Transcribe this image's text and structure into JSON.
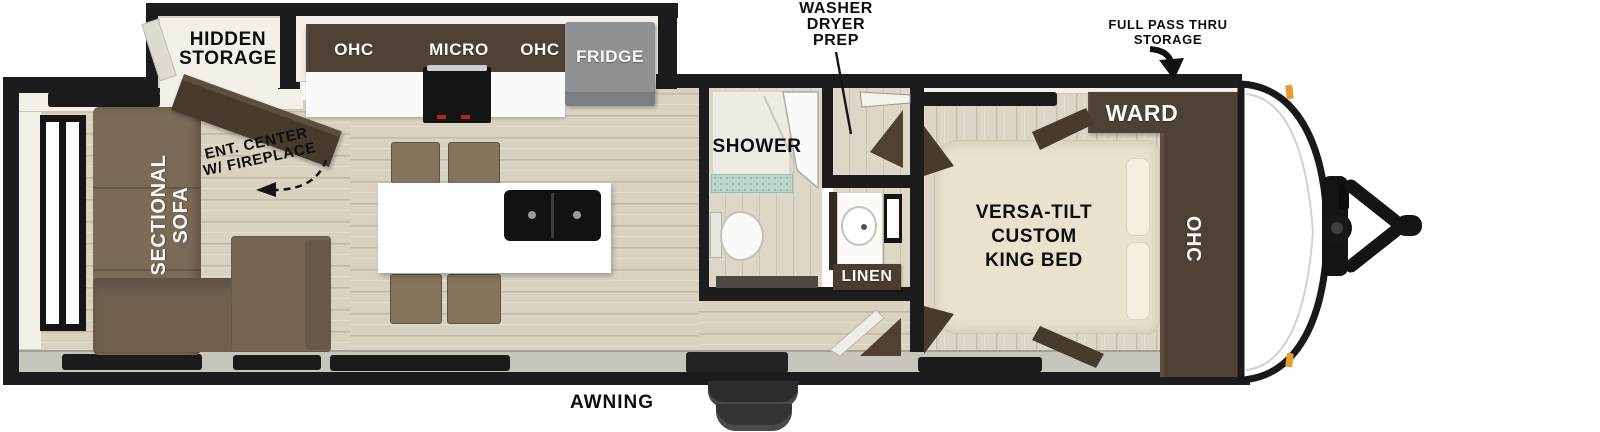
{
  "plan_type": "travel-trailer-floorplan",
  "labels": {
    "hidden_storage": [
      "HIDDEN",
      "STORAGE"
    ],
    "ent_center": [
      "ENT. CENTER",
      "W/ FIREPLACE"
    ],
    "sofa": [
      "SECTIONAL",
      "SOFA"
    ],
    "kitchen": {
      "ohc_left": "OHC",
      "micro": "MICRO",
      "ohc_right": "OHC",
      "fridge": "FRIDGE"
    },
    "bath": {
      "shower": "SHOWER",
      "washer_dryer": [
        "WASHER",
        "DRYER",
        "PREP"
      ],
      "linen": "LINEN"
    },
    "bedroom": {
      "bed": [
        "VERSA-TILT",
        "CUSTOM",
        "KING BED"
      ],
      "ward": "WARD",
      "ohc": "OHC"
    },
    "exterior": {
      "pass_thru": [
        "FULL PASS THRU",
        "STORAGE"
      ],
      "awning": "AWNING"
    }
  },
  "colors": {
    "wall": "#1c1c1e",
    "dark_wood": "#4e4136",
    "sofa_brown": "#7a6b59",
    "chair_brown": "#85745e",
    "floor_tan": "#d9d2c1",
    "fridge_gray": "#8f9294",
    "sink_black": "#121212",
    "shower_pan_teal": "#bcd6cc",
    "linen_brown": "#4a3d2f",
    "marker_light_orange": "#e49d2f",
    "bed_cream": "#e9e2cf"
  }
}
